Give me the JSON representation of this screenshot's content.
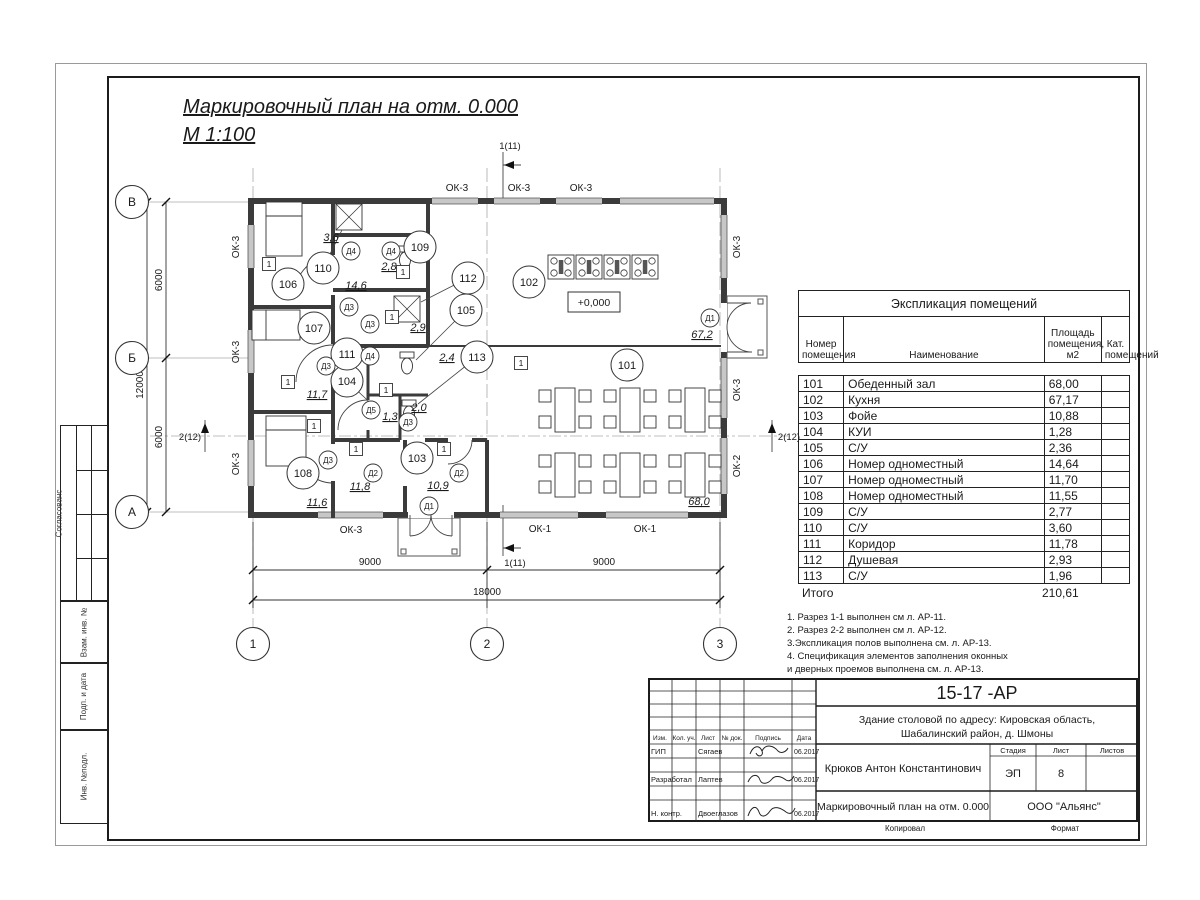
{
  "titles": {
    "main": "Маркировочный план  на отм. 0.000",
    "scale": "М 1:100"
  },
  "plan": {
    "level_mark": "+0,000",
    "marker": "1",
    "axis_v": {
      "v1": "В",
      "v2": "Б",
      "v3": "А"
    },
    "axis_h": {
      "h1": "1",
      "h2": "2",
      "h3": "3"
    },
    "dims": {
      "d6000": "6000",
      "d12000": "12000",
      "d9000": "9000",
      "d18000": "18000"
    },
    "sections": {
      "s1": "1(11)",
      "s2": "2(12)"
    },
    "win": {
      "ok1": "ОК-1",
      "ok2": "ОК-2",
      "ok3": "ОК-3"
    },
    "door": {
      "d1": "Д1",
      "d2": "Д2",
      "d3": "Д3",
      "d4": "Д4",
      "d5": "Д5"
    },
    "nums": {
      "n101": "101",
      "n102": "102",
      "n103": "103",
      "n104": "104",
      "n105": "105",
      "n106": "106",
      "n107": "107",
      "n108": "108",
      "n109": "109",
      "n110": "110",
      "n111": "111",
      "n112": "112",
      "n113": "113"
    },
    "areas": {
      "a101": "68,0",
      "a102": "67,2",
      "a103": "10,9",
      "a104": "1,3",
      "a105": "2,4",
      "a106": "14,6",
      "a107": "11,7",
      "a108": "11,6",
      "a109": "2,8",
      "a110": "3,6",
      "a111": "11,8",
      "a112": "2,9",
      "a113": "2,0"
    }
  },
  "legend": {
    "title": "Экспликация помещений",
    "col_num": "Номер помещения",
    "col_name": "Наименование",
    "col_area": "Площадь помещения, м2",
    "col_cat": "Кат. помещений",
    "rows": [
      {
        "num": "101",
        "name": "Обеденный зал",
        "area": "68,00",
        "cat": ""
      },
      {
        "num": "102",
        "name": "Кухня",
        "area": "67,17",
        "cat": ""
      },
      {
        "num": "103",
        "name": "Фойе",
        "area": "10,88",
        "cat": ""
      },
      {
        "num": "104",
        "name": "КУИ",
        "area": "1,28",
        "cat": ""
      },
      {
        "num": "105",
        "name": "С/У",
        "area": "2,36",
        "cat": ""
      },
      {
        "num": "106",
        "name": "Номер одноместный",
        "area": "14,64",
        "cat": ""
      },
      {
        "num": "107",
        "name": "Номер одноместный",
        "area": "11,70",
        "cat": ""
      },
      {
        "num": "108",
        "name": "Номер одноместный",
        "area": "11,55",
        "cat": ""
      },
      {
        "num": "109",
        "name": "С/У",
        "area": "2,77",
        "cat": ""
      },
      {
        "num": "110",
        "name": "С/У",
        "area": "3,60",
        "cat": ""
      },
      {
        "num": "111",
        "name": "Коридор",
        "area": "11,78",
        "cat": ""
      },
      {
        "num": "112",
        "name": "Душевая",
        "area": "2,93",
        "cat": ""
      },
      {
        "num": "113",
        "name": "С/У",
        "area": "1,96",
        "cat": ""
      }
    ],
    "total_label": "Итого",
    "total": "210,61"
  },
  "notes": [
    {
      "text": "1. Разрез 1-1 выполнен см л. АР-11."
    },
    {
      "text": "2. Разрез 2-2 выполнен см л. АР-12."
    },
    {
      "text": "3.Экспликация полов выполнена  см. л. АР-13."
    },
    {
      "text": "4. Спецификация элементов заполнения оконных"
    },
    {
      "text": " и дверных проемов выполнена  см. л. АР-13."
    }
  ],
  "stamp": {
    "doc_number": "15-17 -АР",
    "address_line1": "Здание столовой по адресу: Кировская область,",
    "address_line2": "Шабалинский район, д. Шмоны",
    "architect": "Крюков Антон Константинович",
    "sheet_title": "Маркировочный план  на отм. 0.000",
    "org": "ООО \"Альянс\"",
    "stage_label": "Стадия",
    "sheet_label": "Лист",
    "sheets_label": "Листов",
    "stage": "ЭП",
    "sheet_no": "8",
    "cols": [
      "Изм.",
      "Кол. уч.",
      "Лист",
      "№ док.",
      "Подпись",
      "Дата"
    ],
    "rows": [
      {
        "role": "ГИП",
        "name": "Сягаев",
        "date": "06.2017"
      },
      {
        "role": "Разработал",
        "name": "Лаптев",
        "date": "06.2017"
      },
      {
        "role": "Н. контр.",
        "name": "Двоеглазов",
        "date": "06.2017"
      }
    ],
    "copied_label": "Копировал",
    "format_label": "Формат"
  },
  "side_strips": {
    "agreed": "Согласованс",
    "vzam": "Взам. инв. №",
    "podp": "Подп. и дата",
    "inv": "Инв. №подл."
  }
}
